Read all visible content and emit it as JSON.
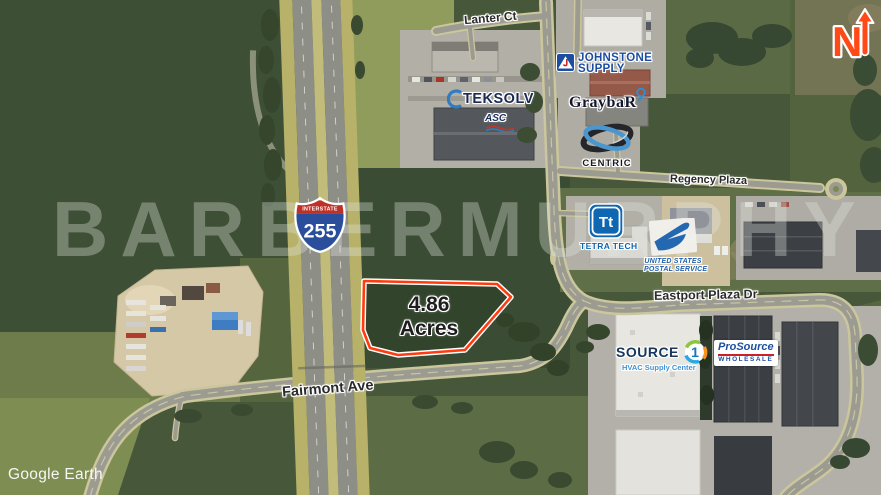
{
  "meta": {
    "credit": "Google Earth",
    "watermark": "BARBERMURPHY",
    "north_label": "N",
    "north_arrow_color": "#ff4a17"
  },
  "parcel": {
    "area_value": "4.86",
    "area_unit": "Acres",
    "outline_color": "#ff3b10"
  },
  "shield": {
    "top_text": "INTERSTATE",
    "route_number": "255",
    "red": "#bf3026",
    "blue": "#2a4d9c"
  },
  "roads": {
    "lanter": "Lanter Ct",
    "regency": "Regency Plaza",
    "eastport": "Eastport Plaza Dr",
    "fairmont": "Fairmont Ave"
  },
  "businesses": {
    "johnstone": {
      "line1": "JOHNSTONE",
      "line2": "SUPPLY",
      "color": "#1c4da1"
    },
    "teksolv": {
      "name": "TEKSOLV",
      "sub": "ASC",
      "color": "#1b2a52"
    },
    "graybar": {
      "name": "GraybaR",
      "color": "#14142c"
    },
    "centric": {
      "name": "CENTRIC",
      "color": "#1a1a1a"
    },
    "tetratech": {
      "abbr": "Tt",
      "name": "TETRA TECH",
      "color": "#0f67b2"
    },
    "usps": {
      "line1": "UNITED STATES",
      "line2": "POSTAL SERVICE",
      "color": "#1f5fae"
    },
    "source1": {
      "name": "SOURCE",
      "number": "1",
      "sub": "HVAC Supply Center",
      "color": "#16365c"
    },
    "prosource": {
      "line1": "ProSource",
      "line2": "WHOLESALE",
      "color": "#1d4fa0",
      "bar_color": "#cc2027"
    }
  }
}
